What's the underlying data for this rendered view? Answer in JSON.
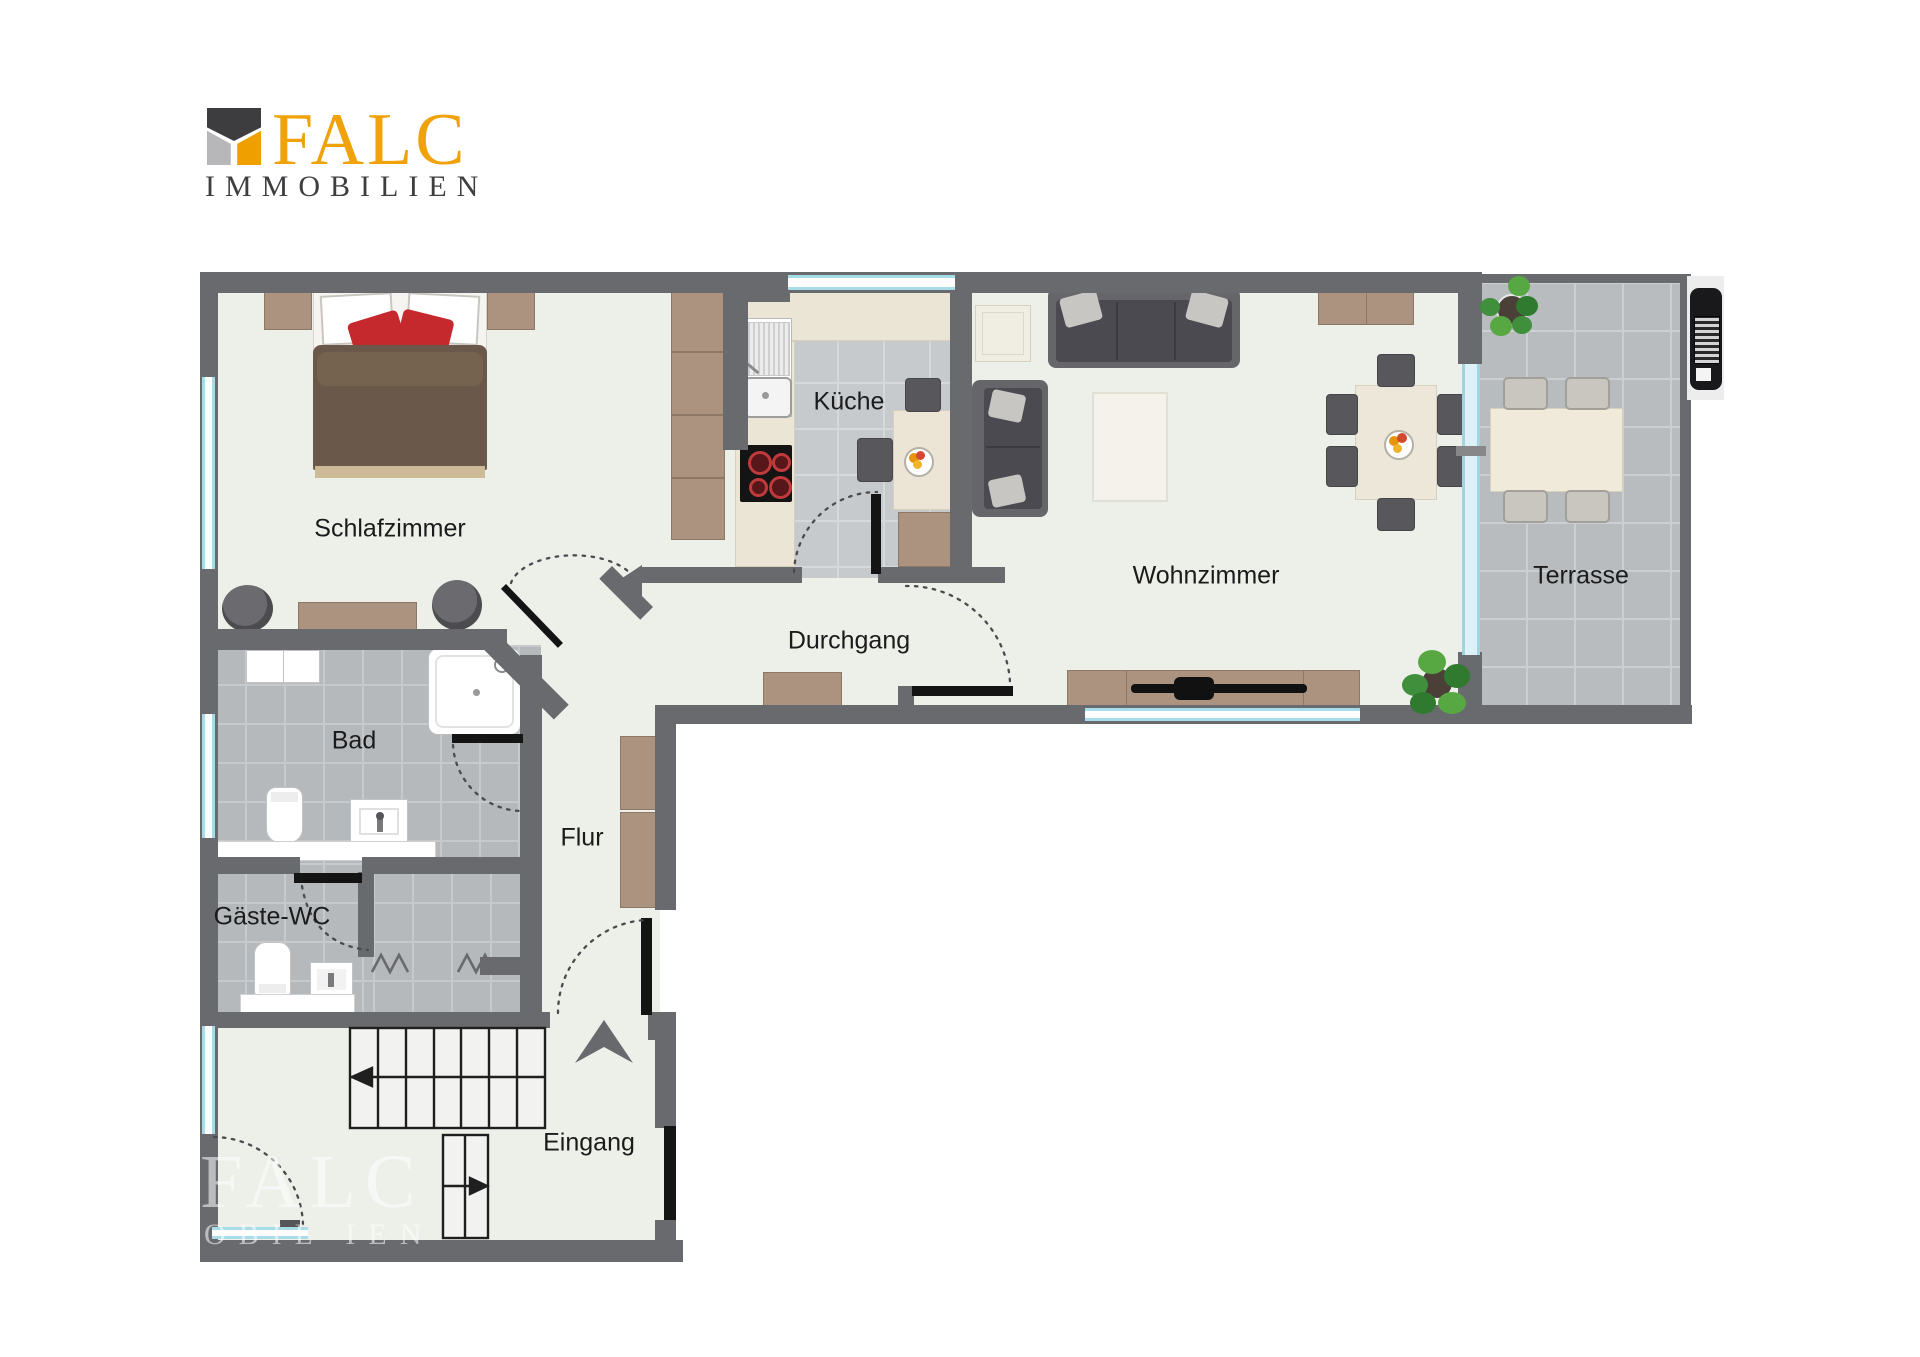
{
  "logo": {
    "brand": "FALC",
    "subtitle": "IMMOBILIEN"
  },
  "watermark": {
    "line1": "FALC",
    "line2": "OBIL IEN"
  },
  "rooms": {
    "schlafzimmer": {
      "label": "Schlafzimmer"
    },
    "kueche": {
      "label": "Küche"
    },
    "wohnzimmer": {
      "label": "Wohnzimmer"
    },
    "terrasse": {
      "label": "Terrasse"
    },
    "durchgang": {
      "label": "Durchgang"
    },
    "bad": {
      "label": "Bad"
    },
    "gaeste_wc": {
      "label": "Gäste-WC"
    },
    "flur": {
      "label": "Flur"
    },
    "eingang": {
      "label": "Eingang"
    }
  },
  "colors": {
    "brand_orange": "#F0A20B",
    "logo_dark": "#3E3E40",
    "logo_gray": "#B7B7B9",
    "wall": "#696A6D",
    "room_floor": "#EDEFE9",
    "bath_tile": "#B5B9BC",
    "kitchen_tile": "#C6CACD",
    "terrace_tile": "#B8BCBF",
    "window_glass": "#A9DCE9",
    "wood": "#AB9380",
    "sofa_gray": "#55555A",
    "pillow_red": "#C5282D",
    "door_black": "#141414"
  }
}
